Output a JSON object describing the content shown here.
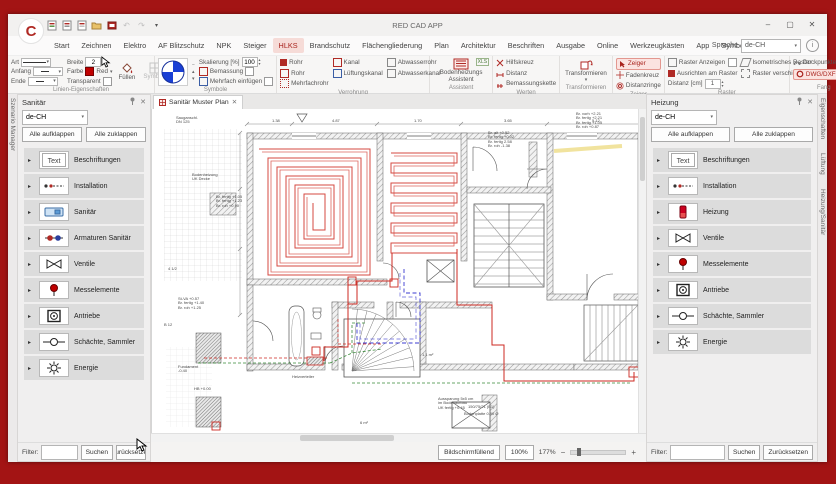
{
  "window": {
    "title": "RED CAD APP",
    "minimize": "–",
    "maximize": "▢",
    "close": "✕"
  },
  "icons": {
    "caret_down": "▾",
    "caret_up": "▴",
    "minus": "−",
    "plus": "+",
    "close": "✕",
    "expander": "▸",
    "undo": "↶",
    "redo": "↷",
    "info": "i",
    "pin": "⊙"
  },
  "language": {
    "label": "Sprache",
    "value": "de-CH"
  },
  "menu": {
    "tabs": [
      "Start",
      "Zeichnen",
      "Elektro",
      "AF Blitzschutz",
      "NPK",
      "Steiger",
      "HLKS",
      "Brandschutz",
      "Flächengliederung",
      "Plan",
      "Architektur",
      "Beschriften",
      "Ausgabe",
      "Online",
      "Werkzeugkästen",
      "App",
      "Symbolbildtool"
    ],
    "active_tab": "HLKS"
  },
  "ribbon": {
    "linien": {
      "title": "Linien-Eigenschaften",
      "art": "Art",
      "anfang": "Anfang",
      "ende": "Ende",
      "breite": "Breite",
      "breite_value": "2",
      "farbe": "Farbe",
      "farbe_value": "Red",
      "transparent": "Transparent",
      "fuellen": "Füllen",
      "symbole_btn": "Symbole"
    },
    "symbole": {
      "title": "Symbole",
      "skalierung": "Skalierung [%]",
      "skalierung_value": "100",
      "bemassung": "Bemassung",
      "mehrfach": "Mehrfach einfügen"
    },
    "verrohrung": {
      "title": "Verrohrung",
      "items": [
        "Rohr",
        "Rohr",
        "Mehrfachrohr",
        "Kanal",
        "Lüftungskanal",
        "Abwasserrohr",
        "Abwasserkanal"
      ]
    },
    "assistent": {
      "title": "Assistent",
      "button": "Bodenheizungs Assistent",
      "badge": "XLS"
    },
    "werten": {
      "title": "Werten",
      "items": [
        "Hilfskreuz",
        "Distanz",
        "Bemassungskette"
      ]
    },
    "transformieren": {
      "title": "Transformieren",
      "button": "Transformieren"
    },
    "zeiger": {
      "title": "Zeiger",
      "items": [
        "Zeiger",
        "Fadenkreuz",
        "Distanzringe"
      ],
      "active": "Zeiger"
    },
    "raster": {
      "title": "Raster",
      "show": "Raster Anzeigen",
      "align": "Ausrichten am Raster",
      "iso": "Isometrisches Raster",
      "move": "Raster verschieben",
      "distanz": "Distanz [cm]",
      "distanz_value": "1"
    },
    "fang": {
      "title": "Fang",
      "items": [
        "Dockpunkte",
        "DWG/DXF Fang"
      ],
      "active": "DWG/DXF Fang"
    }
  },
  "left_panel": {
    "title": "Sanitär",
    "language": "de-CH",
    "expand_all": "Alle aufklappen",
    "collapse_all": "Alle zuklappen",
    "items": [
      {
        "label": "Beschriftungen",
        "icon": "text"
      },
      {
        "label": "Installation",
        "icon": "install"
      },
      {
        "label": "Sanitär",
        "icon": "sink"
      },
      {
        "label": "Armaturen Sanitär",
        "icon": "fitting"
      },
      {
        "label": "Ventile",
        "icon": "valve"
      },
      {
        "label": "Messelemente",
        "icon": "sensor"
      },
      {
        "label": "Antriebe",
        "icon": "drive"
      },
      {
        "label": "Schächte, Sammler",
        "icon": "shaft"
      },
      {
        "label": "Energie",
        "icon": "energy"
      }
    ],
    "filter_label": "Filter:",
    "search": "Suchen",
    "reset": "Zurücksetzen"
  },
  "right_panel": {
    "title": "Heizung",
    "language": "de-CH",
    "expand_all": "Alle aufklappen",
    "collapse_all": "Alle zuklappen",
    "items": [
      {
        "label": "Beschriftungen",
        "icon": "text"
      },
      {
        "label": "Installation",
        "icon": "install"
      },
      {
        "label": "Heizung",
        "icon": "radiator"
      },
      {
        "label": "Ventile",
        "icon": "valve"
      },
      {
        "label": "Messelemente",
        "icon": "sensor"
      },
      {
        "label": "Antriebe",
        "icon": "drive"
      },
      {
        "label": "Schächte, Sammler",
        "icon": "shaft"
      },
      {
        "label": "Energie",
        "icon": "energy"
      }
    ],
    "filter_label": "Filter:",
    "search": "Suchen",
    "reset": "Zurücksetzen"
  },
  "side_tabs": {
    "left": "Szenario Manager",
    "right": [
      "Eigenschaften",
      "Lüftung",
      "Heizung/Sanitär"
    ]
  },
  "canvas": {
    "tab": "Sanitär Muster Plan",
    "status": {
      "fit": "Bildschirmfüllend",
      "hundred": "100%",
      "zoom": "177%"
    },
    "annotations": [
      {
        "text": "Sauganschl.\nDN 125",
        "x": 24,
        "y": 7
      },
      {
        "text": "1.38",
        "x": 120,
        "y": 10
      },
      {
        "text": "4.87",
        "x": 180,
        "y": 10
      },
      {
        "text": "1.70",
        "x": 262,
        "y": 10
      },
      {
        "text": "3.65",
        "x": 352,
        "y": 10
      },
      {
        "text": "5.12",
        "x": 440,
        "y": 10
      },
      {
        "text": "Br. vorh +2.21\nBr. fertig +2.21\nBr. fertig +1.05\nBr. roh +0.87",
        "x": 424,
        "y": 3
      },
      {
        "text": "Br. alt +0.52\nBr. fertig +0.02\nBr. fertig 2.58\nBr. roh -1.38",
        "x": 336,
        "y": 22
      },
      {
        "text": "Bodenheizung\nUK Decke",
        "x": 40,
        "y": 64
      },
      {
        "text": "Br. fertig +1.05\nBr. fertig +1.23\nBr. roh +0.90",
        "x": 64,
        "y": 86
      },
      {
        "text": "St-VA +0.57\nBr. fertig +1.40\nBr. roh +1.25",
        "x": 26,
        "y": 188
      },
      {
        "text": "B 12",
        "x": 12,
        "y": 214
      },
      {
        "text": "4 1/2",
        "x": 16,
        "y": 158
      },
      {
        "text": "1.1 m²",
        "x": 270,
        "y": 244
      },
      {
        "text": "6 m²",
        "x": 208,
        "y": 312
      },
      {
        "text": "Aussparung 5x5 cm\nim Bodenaufbau\nUK fertig +0.45",
        "x": 286,
        "y": 288
      },
      {
        "text": "150/75/21 (B1)",
        "x": 316,
        "y": 296
      },
      {
        "text": "Bodenplatte 0.90 Ø",
        "x": 312,
        "y": 303
      },
      {
        "text": "Fundament\n-0.40",
        "x": 26,
        "y": 256
      },
      {
        "text": "HB +0.00",
        "x": 42,
        "y": 278
      },
      {
        "text": "Heizverteiler",
        "x": 140,
        "y": 266
      }
    ]
  }
}
